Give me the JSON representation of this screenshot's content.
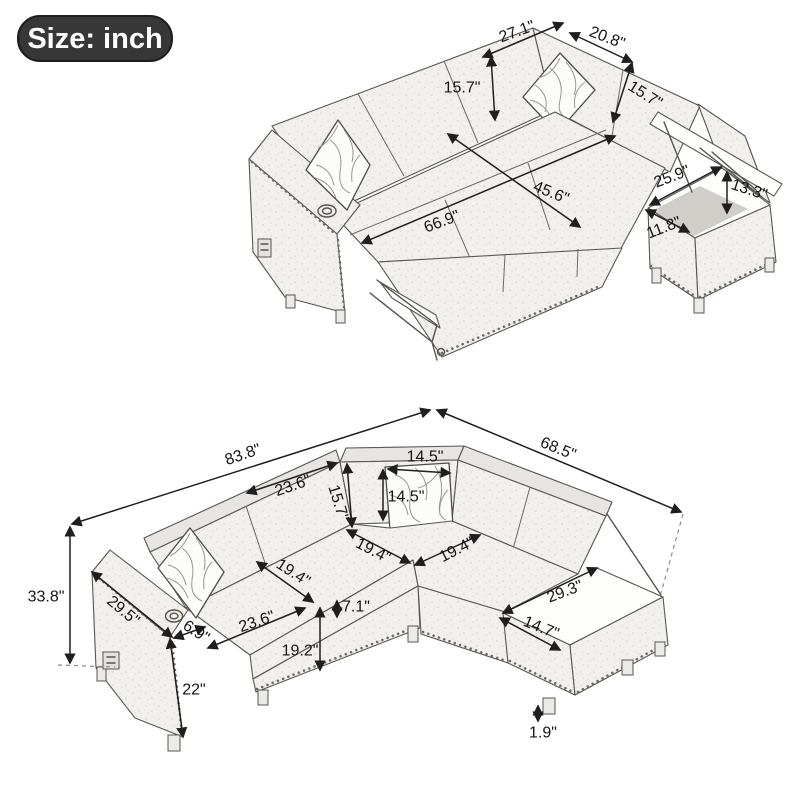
{
  "badge": {
    "label": "Size: inch"
  },
  "unit": "inch",
  "top_view": {
    "description": "sleeper mode with pull-out bed and open storage chaise",
    "dims": {
      "back_left_width": "27.1\"",
      "back_right_width": "20.8\"",
      "back_height_left": "15.7\"",
      "back_height_right": "15.7\"",
      "bed_width": "45.6\"",
      "bed_length": "66.9\"",
      "storage_length": "25.9\"",
      "storage_height": "13.3\"",
      "storage_width": "11.8\""
    }
  },
  "sofa_view": {
    "description": "sectional sofa overall dimensions",
    "dims": {
      "total_width": "83.8\"",
      "total_depth": "68.5\"",
      "total_height": "33.8\"",
      "back_cushion_width": "23.6\"",
      "back_height": "15.7\"",
      "pillow_width": "14.5\"",
      "pillow_height": "14.5\"",
      "seat_depth_left": "19.4\"",
      "seat_depth_corner_left": "19.4\"",
      "seat_depth_corner_right": "19.4\"",
      "seat_width": "23.6\"",
      "cushion_thickness": "7.1\"",
      "seat_height": "19.2\"",
      "arm_depth": "29.5\"",
      "arm_top_width": "6.9\"",
      "arm_height": "22\"",
      "chaise_length": "29.3\"",
      "chaise_width": "14.7\"",
      "leg_height": "1.9\""
    }
  }
}
